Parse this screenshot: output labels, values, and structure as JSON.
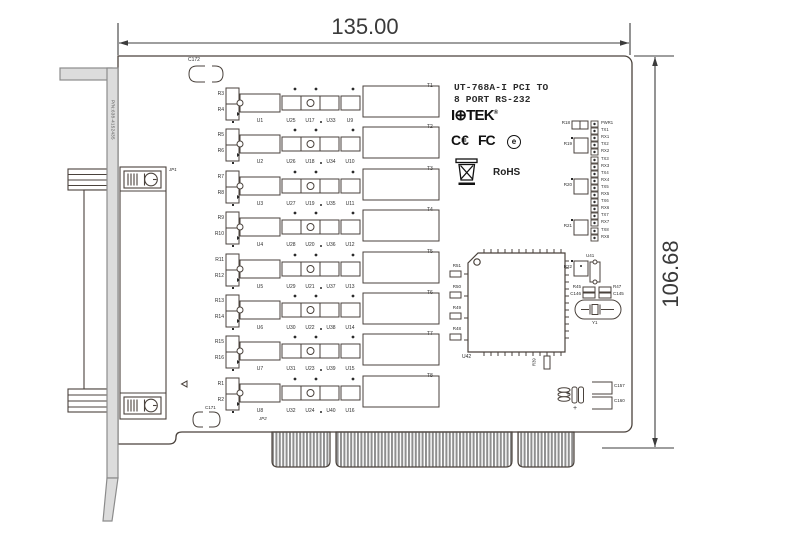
{
  "dimensions": {
    "width": "135.00",
    "height": "106.68"
  },
  "bracket": {
    "part_number": "P/N:638-4152435"
  },
  "title": {
    "line1": "UT-768A-I PCI TO",
    "line2": "8 PORT RS-232"
  },
  "branding": {
    "logo_left": "I",
    "logo_globe": "⊕",
    "logo_right": "TEK",
    "reg": "®",
    "ce": "C€",
    "fcc": "FC",
    "e_mark": "e",
    "rohs": "RoHS"
  },
  "silkscreen": {
    "c172": "C172",
    "jp1": "JP1",
    "c171": "C171",
    "jp2": "JP2",
    "u42": "U42",
    "u41": "U41",
    "y1": "Y1",
    "r39": "R39",
    "r45": "R45",
    "c146": "C146",
    "r47": "R47",
    "c145": "C145",
    "c157": "C157",
    "c160": "C160",
    "r18": "R18",
    "r19": "R19",
    "r20": "R20",
    "r21": "R21",
    "r22": "R22",
    "qfp_left_refs": [
      "R51",
      "R50",
      "R49",
      "R48"
    ],
    "plus": "+"
  },
  "rows": [
    {
      "r_top": "R3",
      "r_bot": "R4",
      "u": "U1",
      "s1": "U25",
      "s2": "U17",
      "s3": "U33",
      "s4": "U9",
      "t": "T1"
    },
    {
      "r_top": "R5",
      "r_bot": "R6",
      "u": "U2",
      "s1": "U26",
      "s2": "U18",
      "s3": "U34",
      "s4": "U10",
      "t": "T2"
    },
    {
      "r_top": "R7",
      "r_bot": "R8",
      "u": "U3",
      "s1": "U27",
      "s2": "U19",
      "s3": "U35",
      "s4": "U11",
      "t": "T3"
    },
    {
      "r_top": "R9",
      "r_bot": "R10",
      "u": "U4",
      "s1": "U28",
      "s2": "U20",
      "s3": "U36",
      "s4": "U12",
      "t": "T4"
    },
    {
      "r_top": "R11",
      "r_bot": "R12",
      "u": "U5",
      "s1": "U29",
      "s2": "U21",
      "s3": "U37",
      "s4": "U13",
      "t": "T5"
    },
    {
      "r_top": "R13",
      "r_bot": "R14",
      "u": "U6",
      "s1": "U30",
      "s2": "U22",
      "s3": "U38",
      "s4": "U14",
      "t": "T6"
    },
    {
      "r_top": "R15",
      "r_bot": "R16",
      "u": "U7",
      "s1": "U31",
      "s2": "U23",
      "s3": "U39",
      "s4": "U15",
      "t": "T7"
    },
    {
      "r_top": "R1",
      "r_bot": "R2",
      "u": "U8",
      "s1": "U32",
      "s2": "U24",
      "s3": "U40",
      "s4": "U16",
      "t": "T8"
    }
  ],
  "leds": [
    "PWR1",
    "TX1",
    "RX1",
    "TX2",
    "RX2",
    "TX3",
    "RX3",
    "TX4",
    "RX4",
    "TX5",
    "RX5",
    "TX6",
    "RX6",
    "TX7",
    "RX7",
    "TX8",
    "RX8"
  ]
}
